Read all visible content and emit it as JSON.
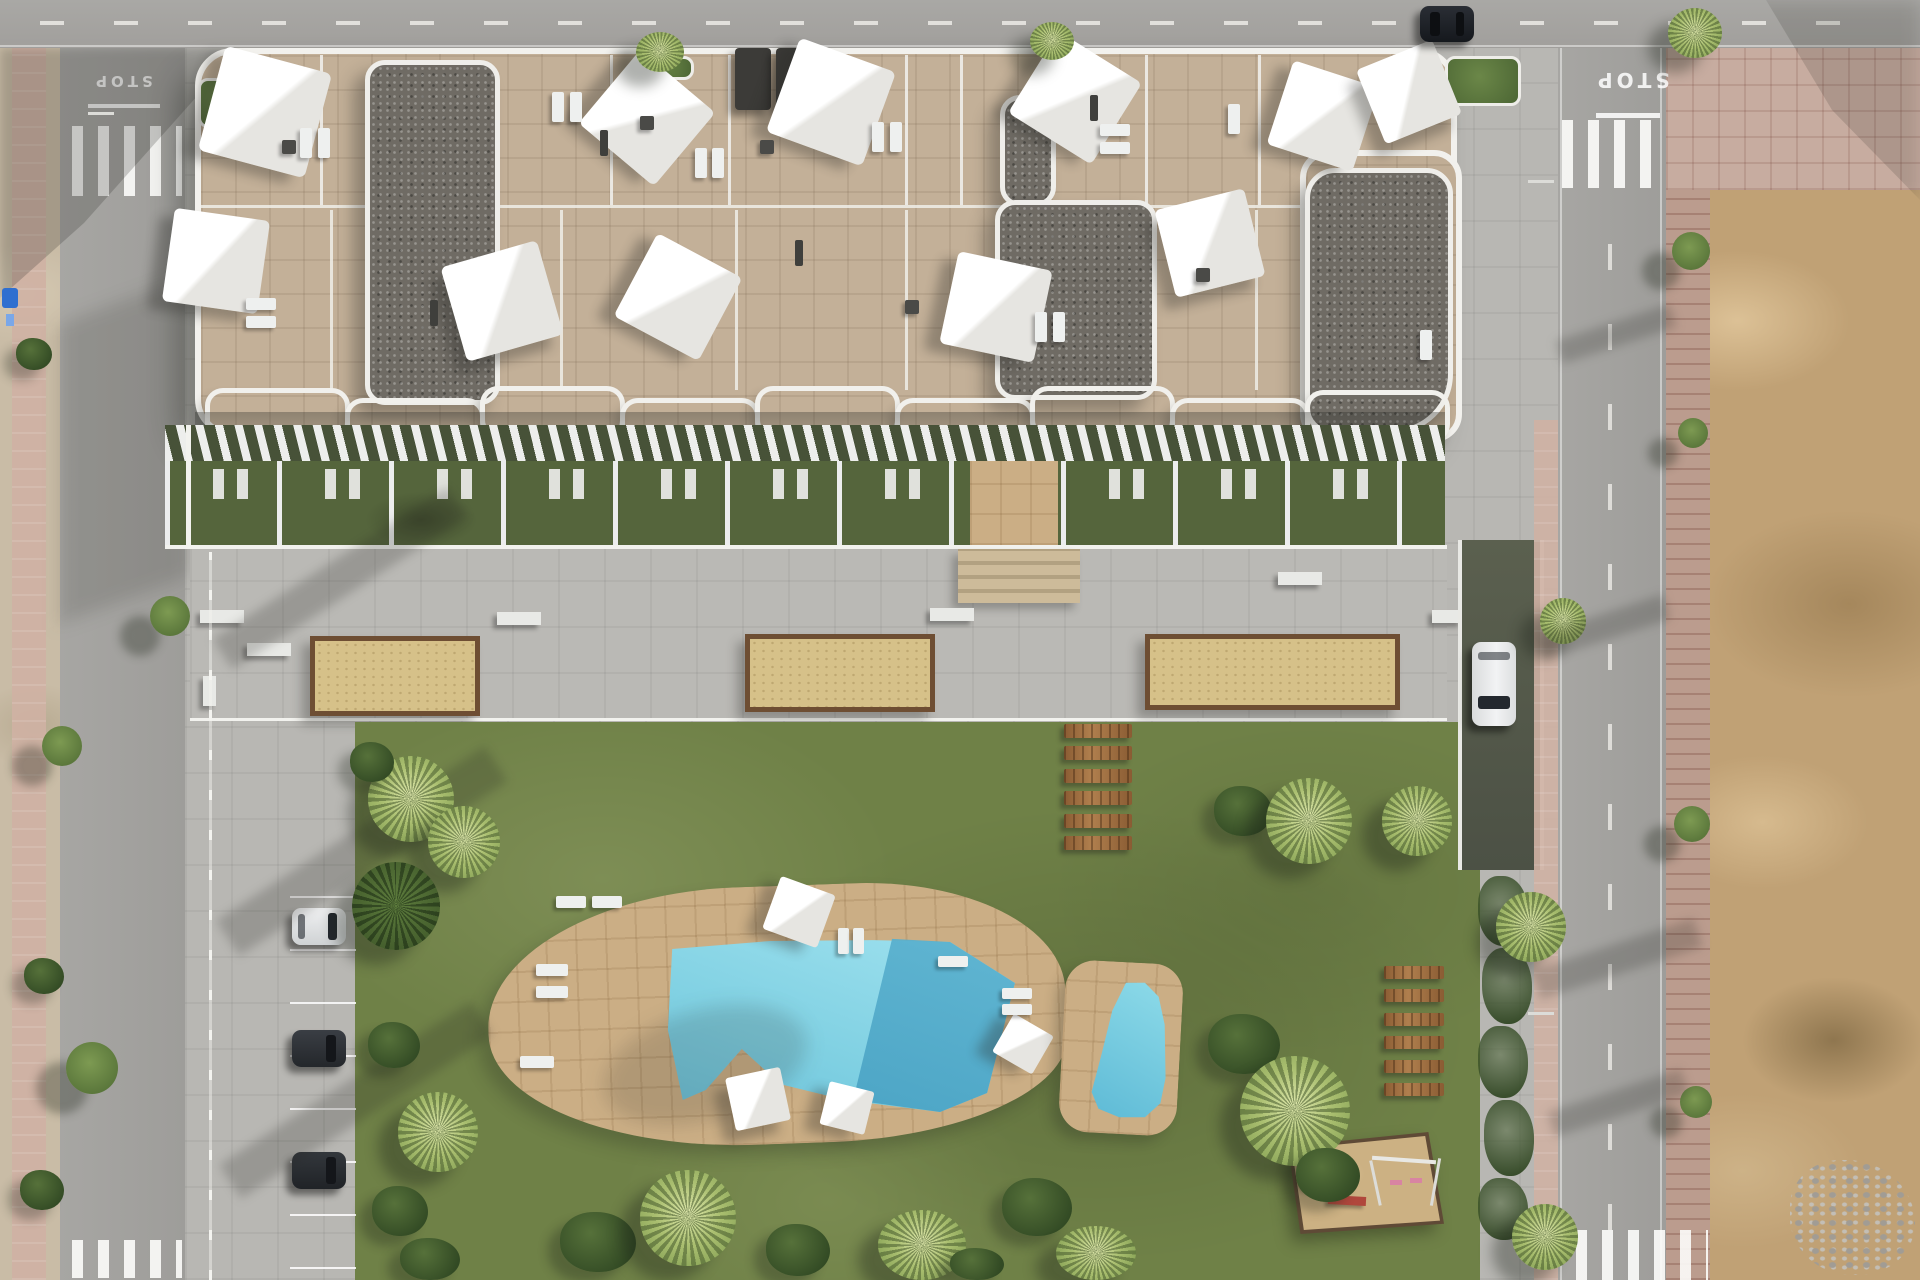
{
  "scene": {
    "type": "aerial-architectural-render",
    "description": "Top-down aerial 3D render of a white residential apartment building with rooftop terraces and shade sails, ground-floor gardens, a paved communal terrace with sand planters, a large lawn with two turquoise swimming pools on stone decks, wooden plank paths, a playground, street parking with cars, and surrounding roads with an undeveloped dirt plot to the east",
    "road_markings": {
      "stop_left": "STOP",
      "stop_right": "STOP"
    },
    "counts": {
      "parked_cars_left": 3,
      "car_on_garage_ramp": 1,
      "car_on_top_road": 1,
      "swimming_pools": 2,
      "sand_planters": 3,
      "plank_path_steps": 6,
      "lawn_plank_loungers": 6,
      "rooftop_shade_sails": 11
    },
    "palette": {
      "road": "#a5a4a1",
      "building_stone": "#c3b098",
      "gravel_roof": "#6f6b64",
      "parapet_white": "#f2f1ed",
      "lawn_green": "#6f8147",
      "garden_green": "#55653c",
      "pool_light": "#7fd0e2",
      "pool_dark": "#3f99bd",
      "deck_tan": "#cbae85",
      "planter_sand": "#d6c189",
      "brick_sidewalk": "#bb9c8e",
      "dirt": "#c0a175",
      "hedge_green": "#324a24",
      "shade_sail_white": "#f4f4f2"
    }
  }
}
